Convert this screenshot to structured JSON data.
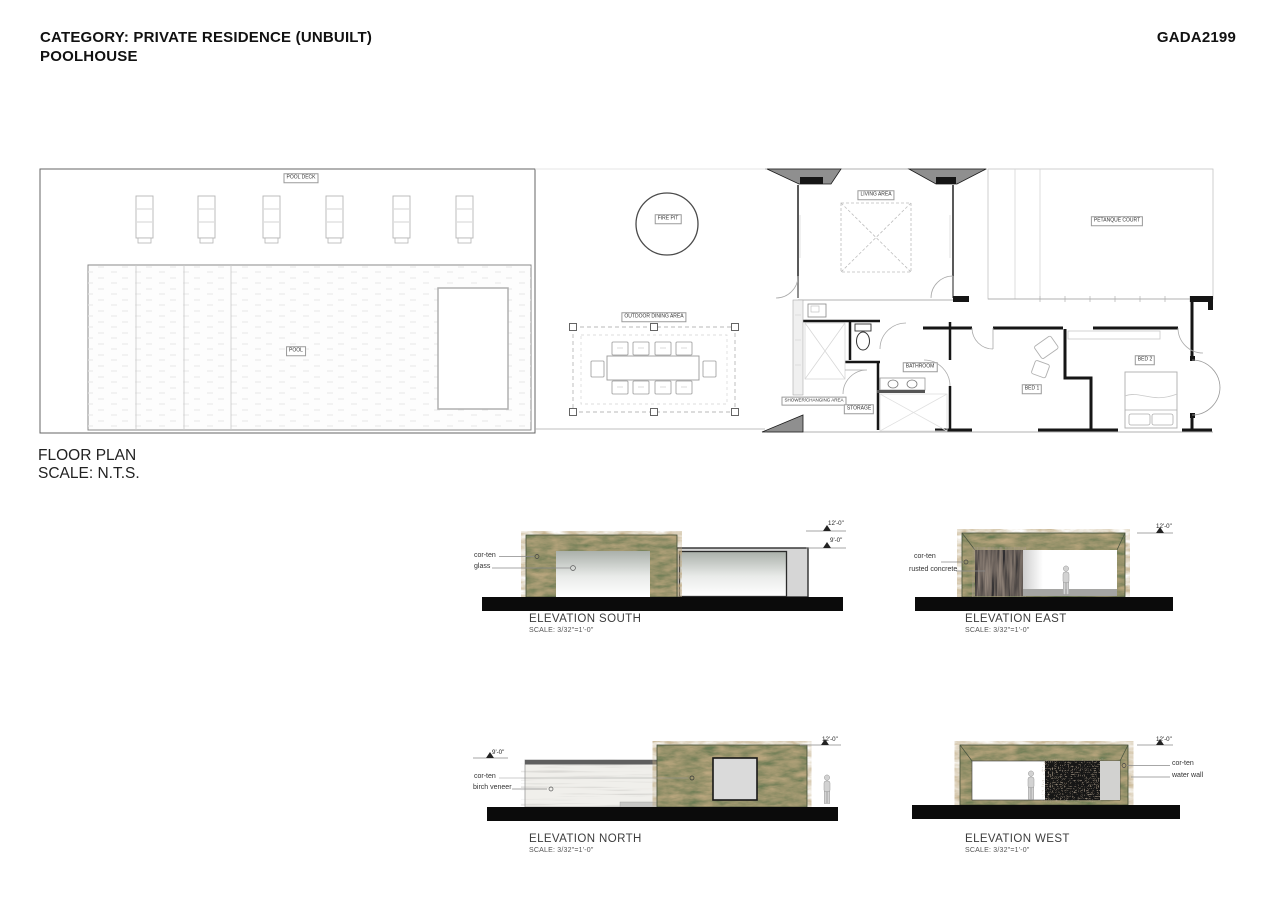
{
  "header": {
    "category_line": "CATEGORY: PRIVATE RESIDENCE (UNBUILT)",
    "project_line": "POOLHOUSE",
    "code": "GADA2199"
  },
  "plan": {
    "title": "FLOOR PLAN",
    "scale": "SCALE: N.T.S.",
    "labels": {
      "pool_deck": "POOL DECK",
      "pool": "POOL",
      "fire_pit": "FIRE PIT",
      "outdoor_dining": "OUTDOOR DINING AREA",
      "living_area": "LIVING AREA",
      "petanque_court": "PETANQUE COURT",
      "bathroom": "BATHROOM",
      "shower_changing": "SHOWER/CHANGING AREA",
      "storage": "STORAGE",
      "bed1": "BED 1",
      "bed2": "BED 2"
    }
  },
  "elevations": {
    "south": {
      "title": "ELEVATION SOUTH",
      "scale": "SCALE: 3/32\"=1'-0\"",
      "ann1": "cor-ten",
      "ann2": "glass",
      "dim1": "12'-0\"",
      "dim2": "9'-0\""
    },
    "east": {
      "title": "ELEVATION EAST",
      "scale": "SCALE: 3/32\"=1'-0\"",
      "ann1": "cor-ten",
      "ann2": "rusted concrete",
      "dim1": "12'-0\""
    },
    "north": {
      "title": "ELEVATION NORTH",
      "scale": "SCALE: 3/32\"=1'-0\"",
      "ann1": "cor-ten",
      "ann2": "birch veneer",
      "dim1": "9'-0\"",
      "dim2": "12'-0\""
    },
    "west": {
      "title": "ELEVATION WEST",
      "scale": "SCALE: 3/32\"=1'-0\"",
      "ann1": "cor-ten",
      "ann2": "water wall",
      "dim1": "12'-0\""
    }
  },
  "colors": {
    "corten_green": "#6b7c54",
    "ground_black": "#0b0b0b",
    "wall_black": "#161616",
    "water_wall_dark": "#191613",
    "rusted_concrete_dark": "#26262b"
  }
}
